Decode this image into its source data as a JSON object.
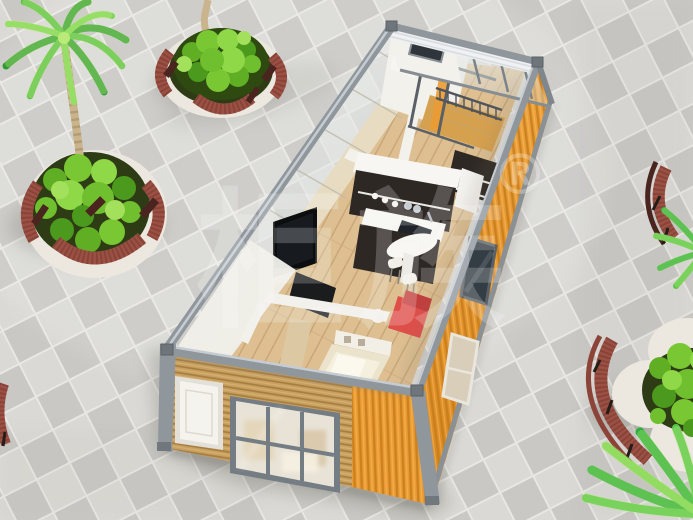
{
  "watermark": {
    "brand": "柜族",
    "registered": "®"
  },
  "palette": {
    "plaza_light": "#dad9d5",
    "plaza_dark": "#c9c8c4",
    "grout": "#e8e7e3",
    "container_orange": "#eb9b33",
    "orange_stripe": "#c47c1c",
    "frame_gray": "#8f969c",
    "frame_light": "#c6ccd1",
    "wood_wall": "#c8a05f",
    "wood_stripe": "#a57d42",
    "interior_floor": "#ddbf92",
    "plank_line": "#c5a273",
    "white_wall": "#f2f1ec",
    "dark_cabinet": "#2e2824",
    "red_sofa": "#df4f4a",
    "bench_wood": "#9c5044",
    "bench_dark": "#6f352c",
    "planter_stone": "#ece7df",
    "soil_dark": "#2e3c16",
    "foliage": "#6fbf2e",
    "foliage_dark": "#3f8a1a",
    "palm_trunk": "#c9b48d",
    "glass_tint": "#dfe7e8",
    "tv_black": "#0c0d0f",
    "deck_wood": "#d6a14f",
    "shadow": "#6f6f66"
  }
}
